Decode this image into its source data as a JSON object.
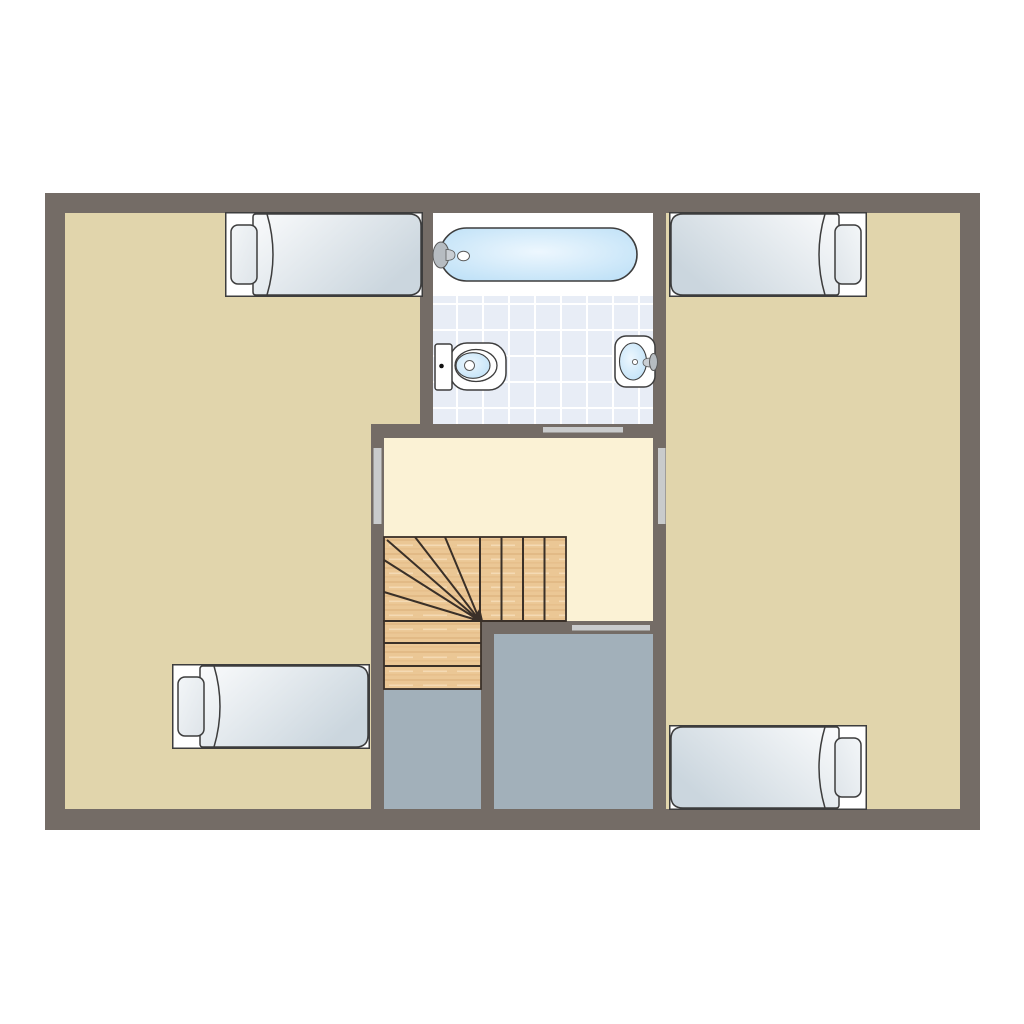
{
  "page": {
    "background": "#FFFFFF",
    "description": "second-floor house plan with four single beds, bathroom and winder staircase"
  },
  "colors": {
    "wall": "#746C66",
    "bedroom_floor": "#E1D5AC",
    "hall_floor": "#FBF2D5",
    "gray_floor": "#A2B0BA",
    "tile_base": "#E8EDF6",
    "tile_line": "#FFFFFF",
    "white": "#FFFFFF",
    "outline": "#3D3D3D",
    "water_edge": "#B9DEF6",
    "water_center": "#EDF7FE",
    "wood": "#EBC795",
    "wood_grain": "#D2A066",
    "wood_light": "#F6DFBC",
    "stair_line": "#3A3028",
    "door_bar": "#C9CBCC",
    "mattress_light": "#FAFBFC",
    "mattress_shade": "#CBD6DE",
    "pillow_light": "#F3F6F8",
    "pillow_shade": "#DEE4E9",
    "metal": "#B6BCC1",
    "metal_light": "#C9CED3",
    "metal_stroke": "#5A5A5A",
    "dot_black": "#111111"
  },
  "plan": {
    "rooms": [
      {
        "name": "bedroom-left",
        "floor": "beige"
      },
      {
        "name": "bedroom-right",
        "floor": "beige"
      },
      {
        "name": "bathroom",
        "floor": "tile"
      },
      {
        "name": "landing-hall",
        "floor": "cream"
      },
      {
        "name": "stairwell-bay-left",
        "floor": "gray"
      },
      {
        "name": "stairwell-bay-right",
        "floor": "gray"
      }
    ],
    "fixtures": [
      {
        "name": "single-bed",
        "count": 4
      },
      {
        "name": "bathtub",
        "count": 1
      },
      {
        "name": "toilet",
        "count": 1
      },
      {
        "name": "washbasin",
        "count": 1
      },
      {
        "name": "winder-staircase",
        "count": 1
      }
    ],
    "door_openings": 4
  }
}
